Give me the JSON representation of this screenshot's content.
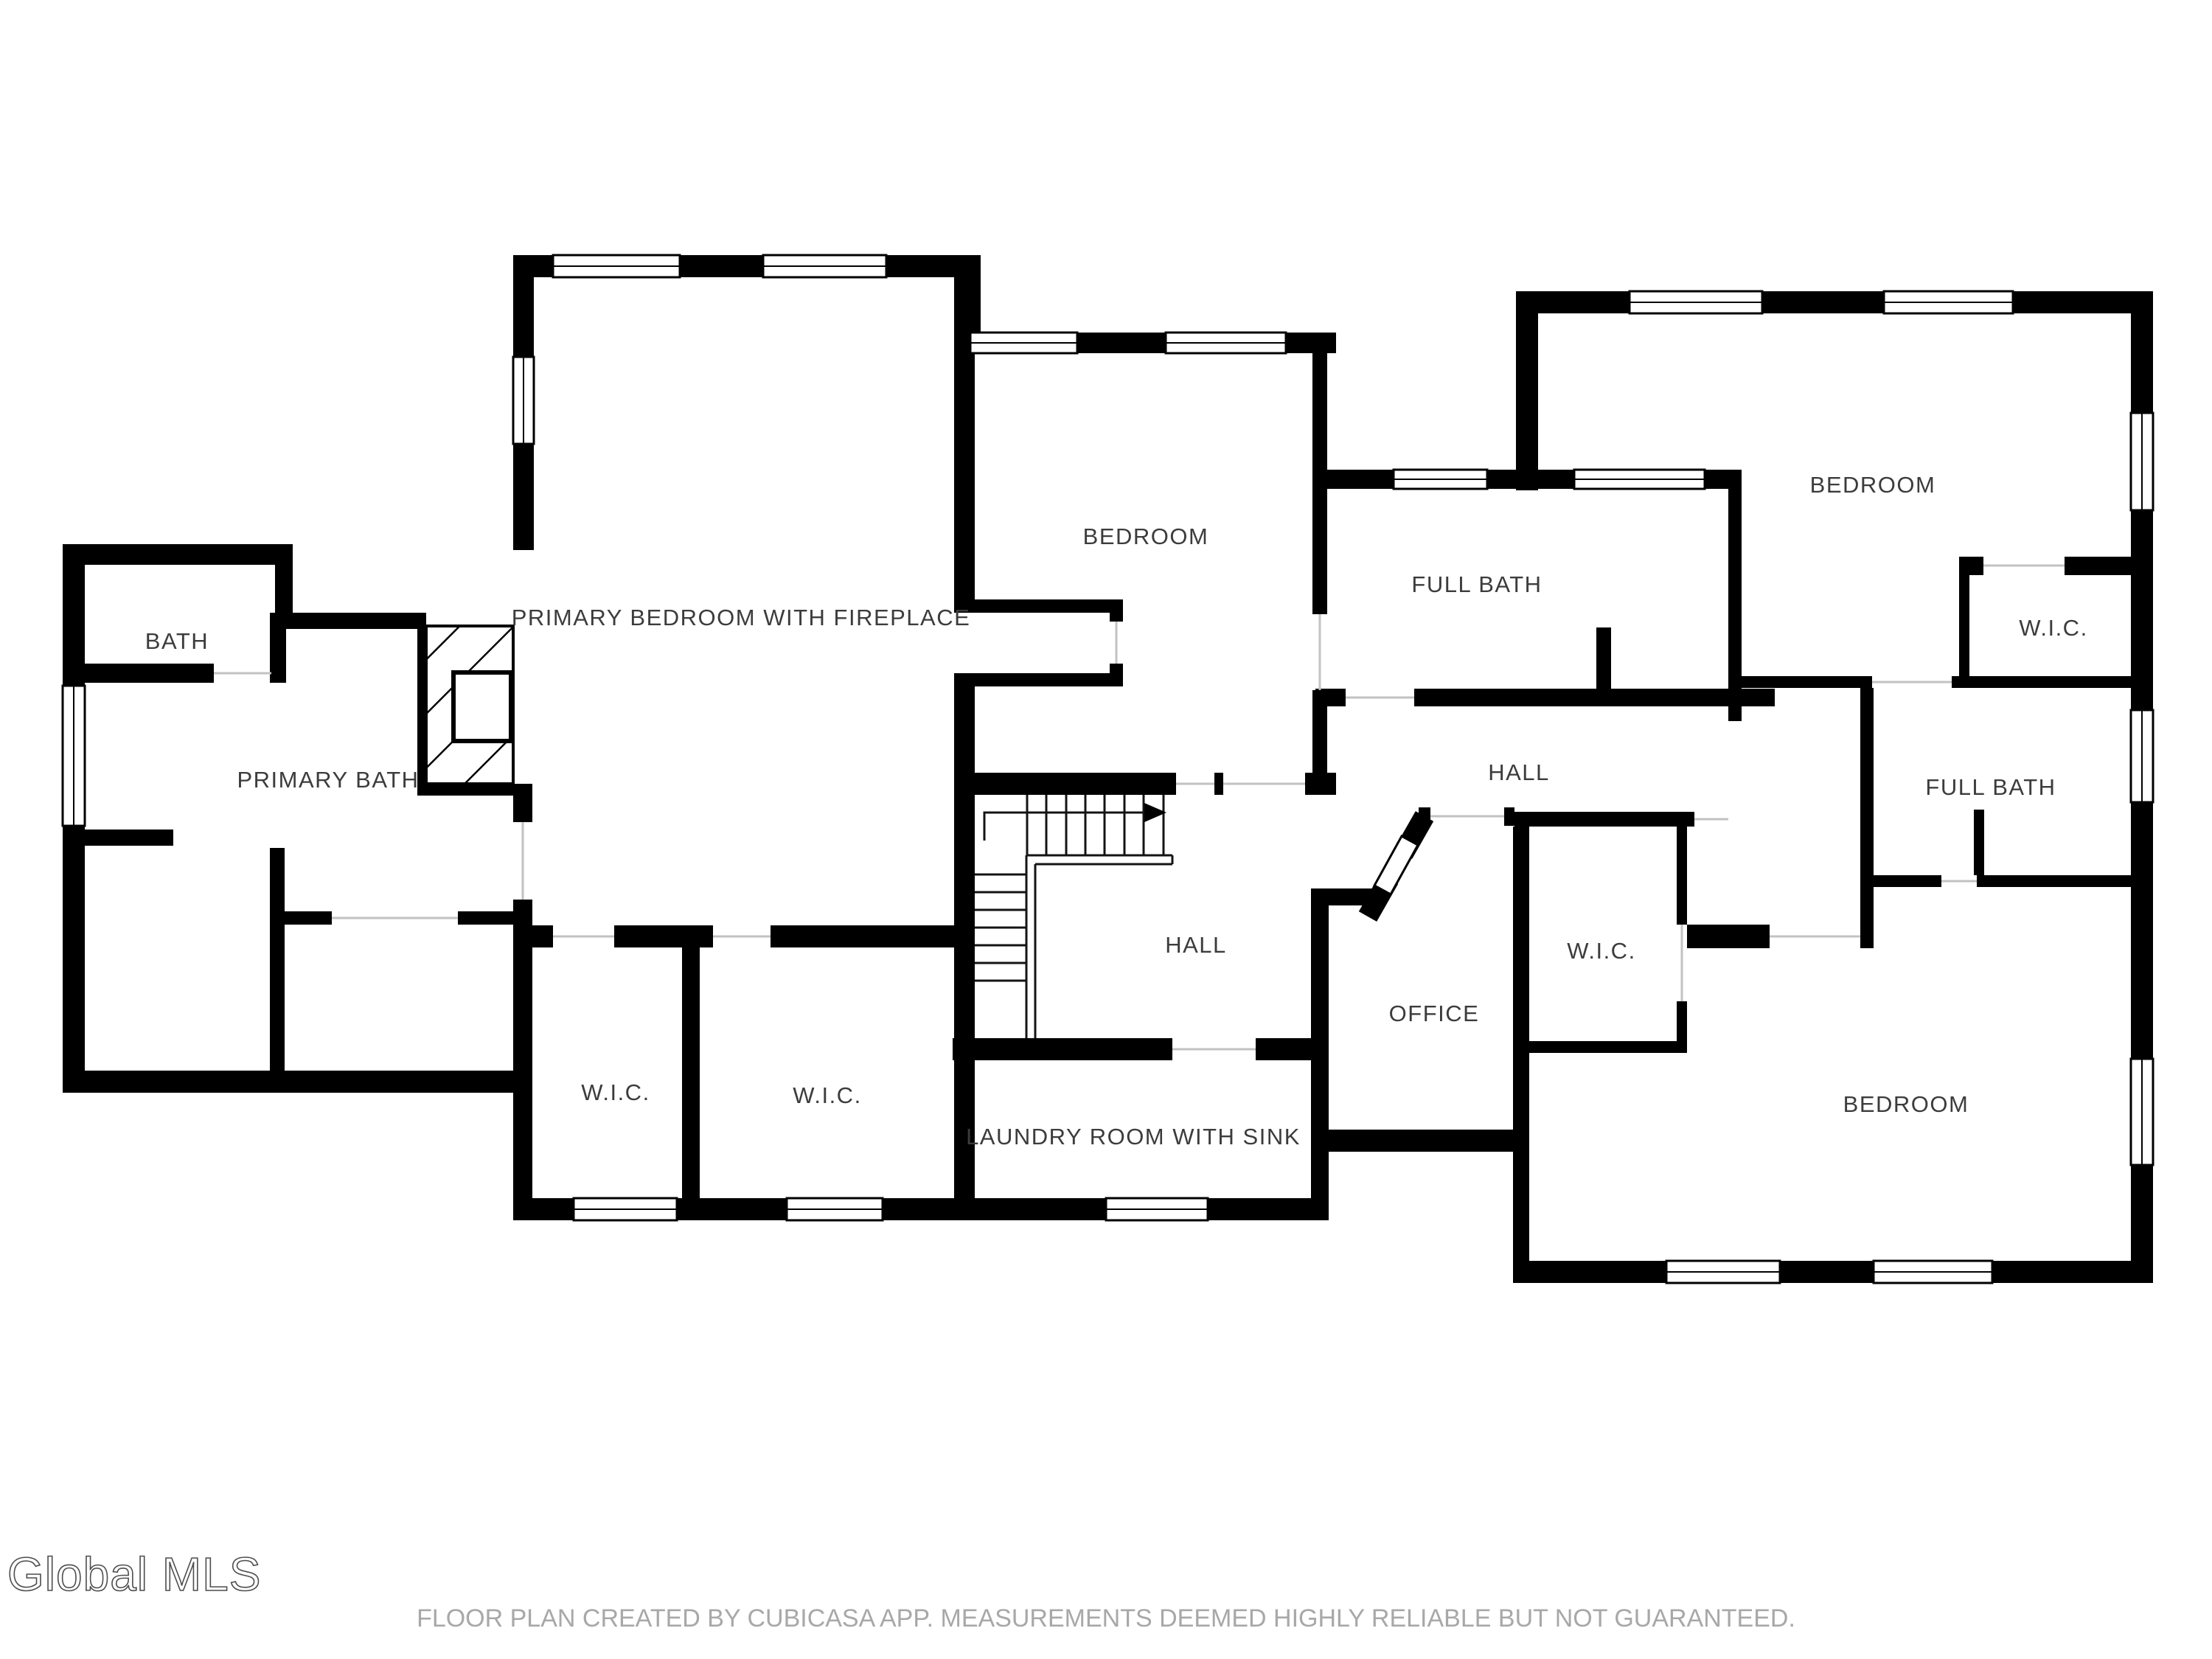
{
  "plan": {
    "type": "floor-plan",
    "rooms": [
      {
        "id": "bath",
        "label": "BATH"
      },
      {
        "id": "primary-bath",
        "label": "PRIMARY BATH"
      },
      {
        "id": "primary-bedroom",
        "label": "PRIMARY BEDROOM WITH FIREPLACE"
      },
      {
        "id": "bedroom-center",
        "label": "BEDROOM"
      },
      {
        "id": "full-bath-center",
        "label": "FULL BATH"
      },
      {
        "id": "bedroom-top-right",
        "label": "BEDROOM"
      },
      {
        "id": "wic-top-right",
        "label": "W.I.C."
      },
      {
        "id": "hall-upper",
        "label": "HALL"
      },
      {
        "id": "full-bath-right",
        "label": "FULL BATH"
      },
      {
        "id": "hall-lower",
        "label": "HALL"
      },
      {
        "id": "office",
        "label": "OFFICE"
      },
      {
        "id": "wic-center",
        "label": "W.I.C."
      },
      {
        "id": "wic-left",
        "label": "W.I.C."
      },
      {
        "id": "wic-right",
        "label": "W.I.C."
      },
      {
        "id": "laundry",
        "label": "LAUNDRY ROOM WITH SINK"
      },
      {
        "id": "bedroom-bottom-right",
        "label": "BEDROOM"
      }
    ],
    "features": {
      "stairs_arrow_direction": "up",
      "fireplace": "hatched chimney with firebox"
    }
  },
  "logo": {
    "text": "Global MLS"
  },
  "footer": {
    "disclaimer": "FLOOR PLAN CREATED BY CUBICASA APP. MEASUREMENTS DEEMED HIGHLY RELIABLE BUT NOT GUARANTEED."
  },
  "colors": {
    "background": "#ffffff",
    "wall": "#000000",
    "room_label": "#3c3c3c",
    "door_opening": "#c2c2c2",
    "footer_text": "#a8a8a8",
    "logo_outline": "#4d4d4d"
  }
}
